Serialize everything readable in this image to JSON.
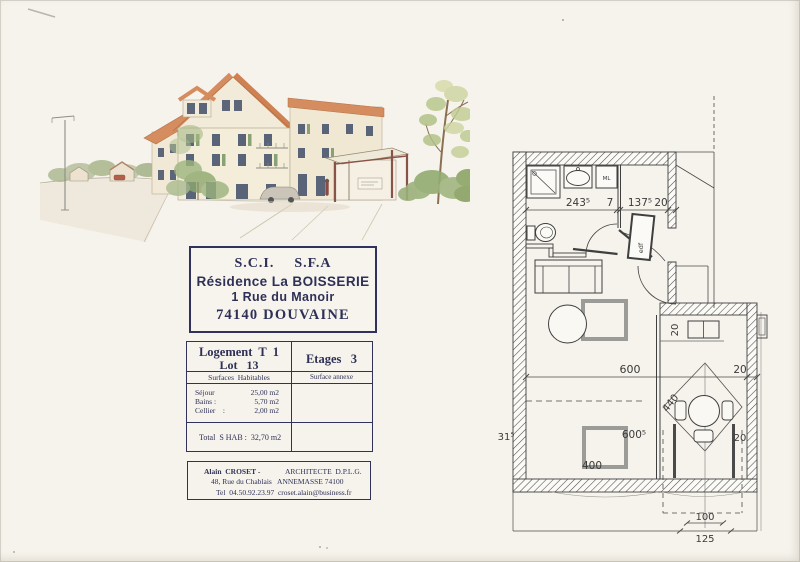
{
  "title_block": {
    "sci": "S.C.I.",
    "sfa": "S.F.A",
    "residence": "Résidence La BOISSERIE",
    "street": "1 Rue du Manoir",
    "city": "74140 DOUVAINE"
  },
  "unit_block": {
    "logement": "Logement  T  1",
    "lot": "Lot   13",
    "etages": "Etages   3",
    "surfaces_header": "Surfaces  Habitables",
    "annexe_header": "Surface annexe",
    "rows": [
      {
        "label": "Séjour",
        "value": "25,00 m2"
      },
      {
        "label": "Bains :",
        "value": "5,70 m2"
      },
      {
        "label": "Cellier    :",
        "value": "2,00 m2"
      }
    ],
    "total": "Total  S HAB :  32,70 m2"
  },
  "architect_block": {
    "name": "Alain  CROSET -",
    "title": "ARCHITECTE  D.P.L.G.",
    "address": "48, Rue du Chablais   ANNEMASSE 74100",
    "contact": "Tel  04.50.92.23.97  croset.alain@business.fr"
  },
  "plan": {
    "dim_bath_width": "243⁵",
    "dim_partition": "7",
    "dim_hall_width": "137⁵",
    "dim_wall": "20",
    "dim_room_width": "600",
    "dim_room_wall": "20",
    "dim_left": "31⁵",
    "dim_bed": "600⁵",
    "dim_bed_width": "400",
    "dim_balcony_diag": "440",
    "dim_balcony_wall_top": "20",
    "dim_balcony_wall_right": "20",
    "dim_100": "100",
    "dim_125": "125",
    "washing_machine": "ML",
    "electric_panel": "edf"
  }
}
